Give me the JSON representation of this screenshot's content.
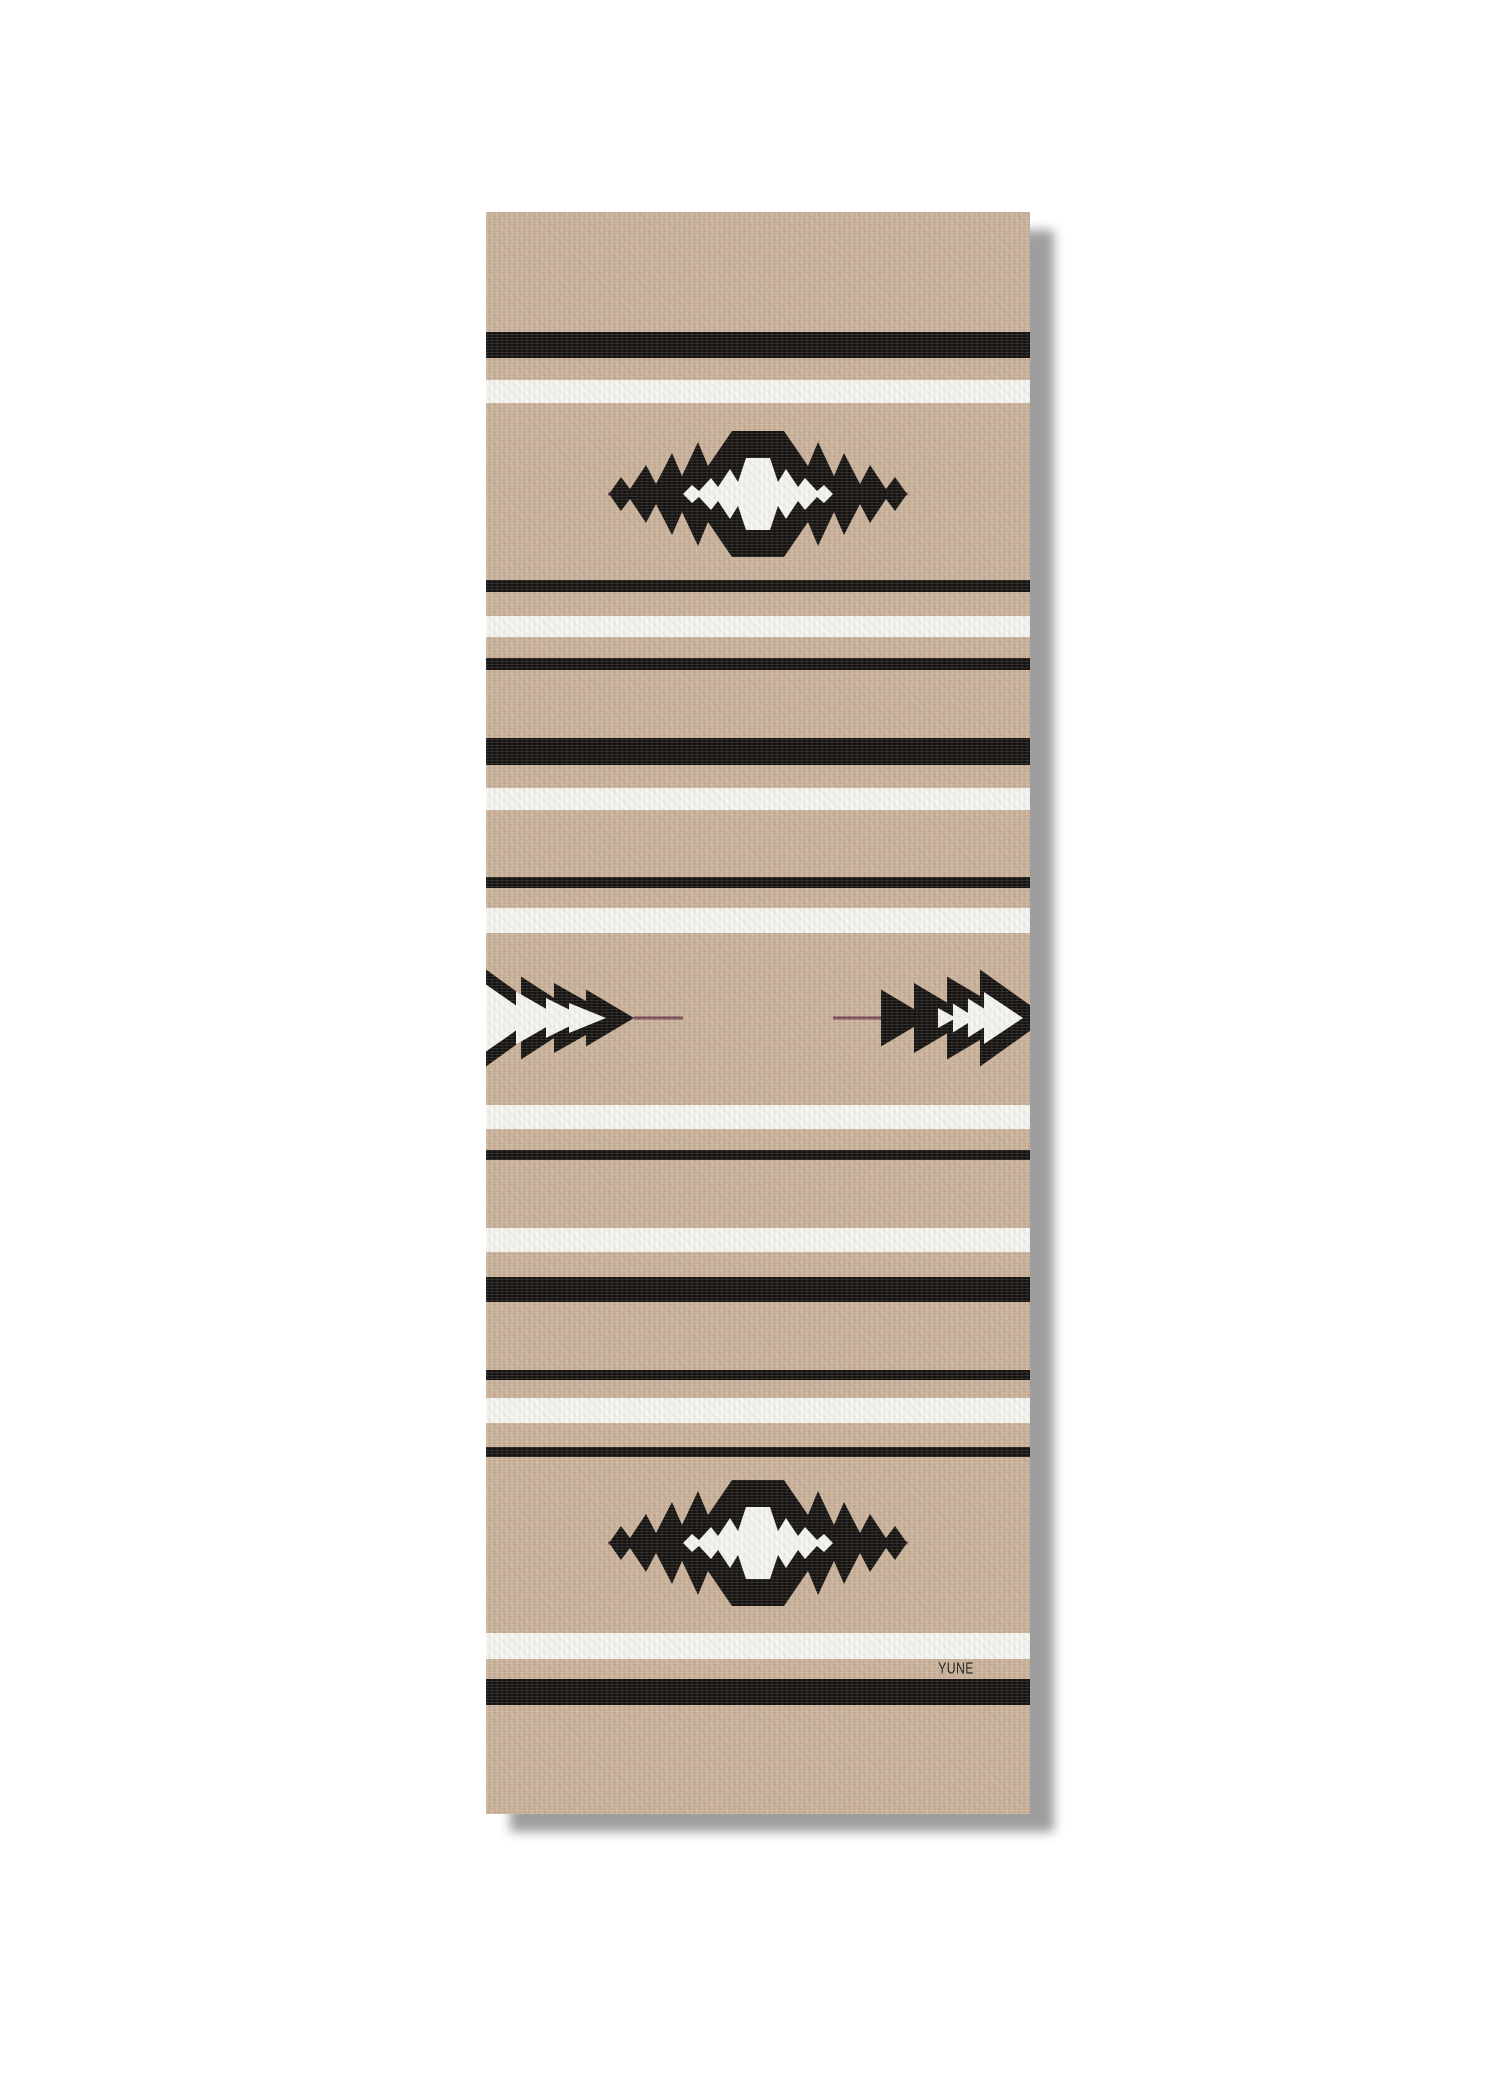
{
  "product": {
    "brand": "YUNE",
    "item": "yoga mat",
    "pattern": "southwest serape stripe with serrated diamond and arrow motifs"
  },
  "canvas": {
    "width": 1500,
    "height": 2100,
    "background": "#ffffff"
  },
  "mat": {
    "left": 486,
    "top": 212,
    "width": 544,
    "height": 1602,
    "colors": {
      "base": "#cab29a",
      "black": "#141210",
      "white": "#f6f5f1",
      "accent": "#7b4a59",
      "shadow": "rgba(0,0,0,0.38)"
    },
    "brand_label": "YUNE",
    "brand_pos": {
      "x": 470,
      "y": 1457
    }
  },
  "stripes": [
    {
      "y": 120,
      "h": 26,
      "color": "black"
    },
    {
      "y": 168,
      "h": 23,
      "color": "white"
    },
    {
      "y": 368,
      "h": 12,
      "color": "black"
    },
    {
      "y": 404,
      "h": 21,
      "color": "white"
    },
    {
      "y": 446,
      "h": 12,
      "color": "black"
    },
    {
      "y": 526,
      "h": 27,
      "color": "black"
    },
    {
      "y": 576,
      "h": 22,
      "color": "white"
    },
    {
      "y": 665,
      "h": 11,
      "color": "black"
    },
    {
      "y": 696,
      "h": 25,
      "color": "white"
    },
    {
      "y": 893,
      "h": 24,
      "color": "white"
    },
    {
      "y": 938,
      "h": 10,
      "color": "black"
    },
    {
      "y": 1016,
      "h": 24,
      "color": "white"
    },
    {
      "y": 1065,
      "h": 25,
      "color": "black"
    },
    {
      "y": 1158,
      "h": 10,
      "color": "black"
    },
    {
      "y": 1186,
      "h": 25,
      "color": "white"
    },
    {
      "y": 1235,
      "h": 10,
      "color": "black"
    },
    {
      "y": 1421,
      "h": 26,
      "color": "white"
    },
    {
      "y": 1467,
      "h": 26,
      "color": "black"
    }
  ],
  "motifs": {
    "diamonds": [
      {
        "cx": 272,
        "cy": 282
      },
      {
        "cx": 272,
        "cy": 1331
      }
    ],
    "diamond_size": {
      "half_w": 149,
      "half_h": 63
    },
    "diamond_line": {
      "x1": 82,
      "x2": 464,
      "thickness": 3
    },
    "arrows": {
      "cy": 806,
      "left_line": {
        "x1": 148,
        "x2": 197,
        "thickness": 3
      },
      "right_line": {
        "x1": 347,
        "x2": 395,
        "thickness": 3
      }
    }
  }
}
